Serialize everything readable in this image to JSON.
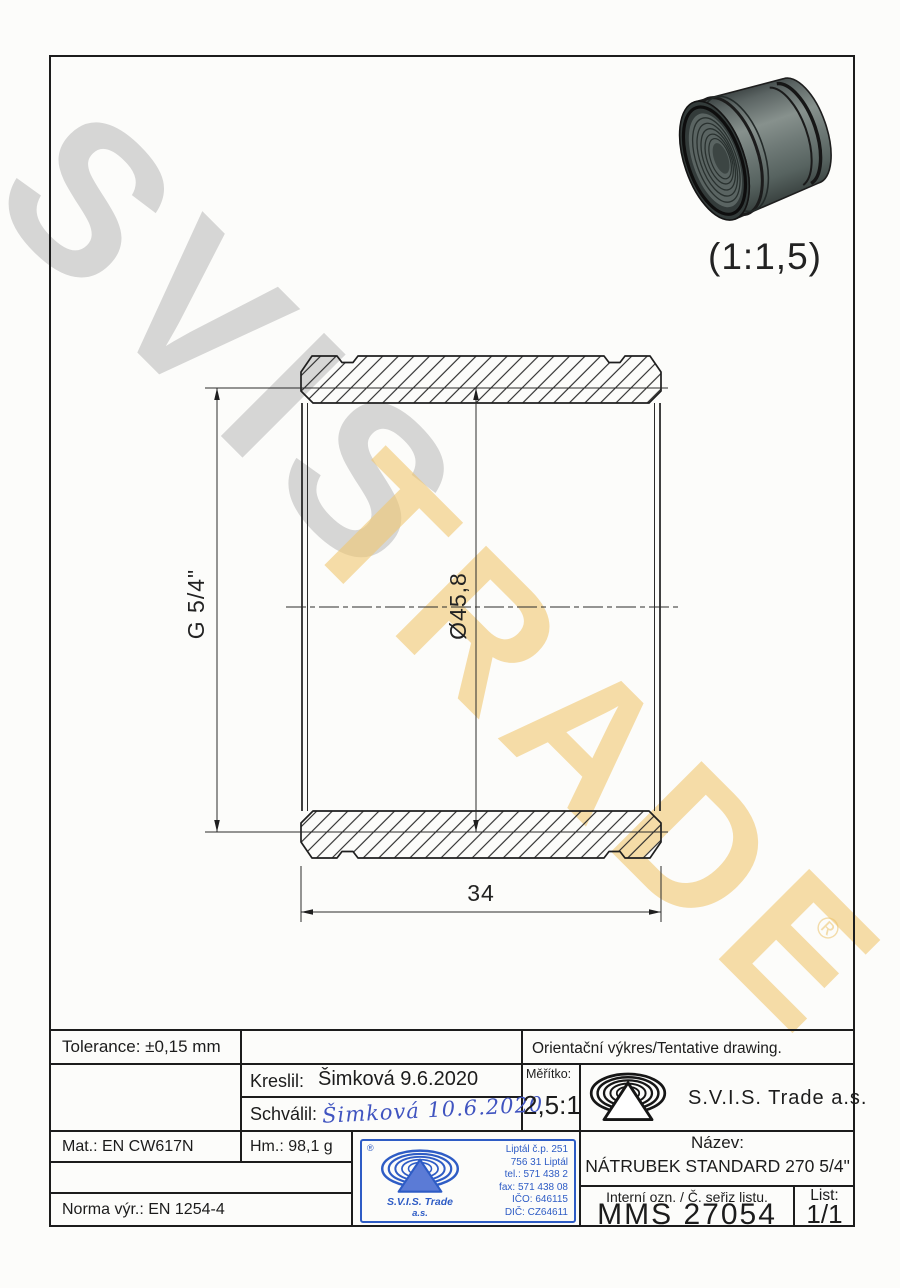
{
  "watermark": {
    "line1": "SVIS",
    "line2": "TRADE",
    "registered": "®"
  },
  "preview": {
    "scale_note": "(1:1,5)"
  },
  "dimensions": {
    "thread": "G 5/4\"",
    "diameter": "Ø45,8",
    "length": "34"
  },
  "title_block": {
    "tolerance": "Tolerance: ±0,15 mm",
    "orientation_note": "Orientační výkres/Tentative drawing.",
    "drawn_label": "Kreslil:",
    "drawn_value": "Šimková 9.6.2020",
    "approved_label": "Schválil:",
    "approved_signature": "Šimková 10.6.2020",
    "scale_label": "Měřítko:",
    "scale_value": "2,5:1",
    "company": "S.V.I.S. Trade a.s.",
    "material": "Mat.: EN CW617N",
    "mass": "Hm.: 98,1 g",
    "norm": "Norma výr.: EN 1254-4",
    "name_label": "Název:",
    "name_value": "NÁTRUBEK STANDARD 270 5/4\"",
    "internal_label": "Interní ozn. / Č. seřiz listu.",
    "internal_value": "MMS 27054",
    "sheet_label": "List:",
    "sheet_value": "1/1"
  },
  "stamp": {
    "registered": "®",
    "company_line1": "S.V.I.S. Trade",
    "company_line2": "a.s.",
    "address_lines": [
      "Liptál č.p. 251",
      "756 31 Liptál",
      "tel.: 571 438 2",
      "fax: 571 438 08",
      "IČO: 646115",
      "DIČ: CZ64611"
    ]
  }
}
